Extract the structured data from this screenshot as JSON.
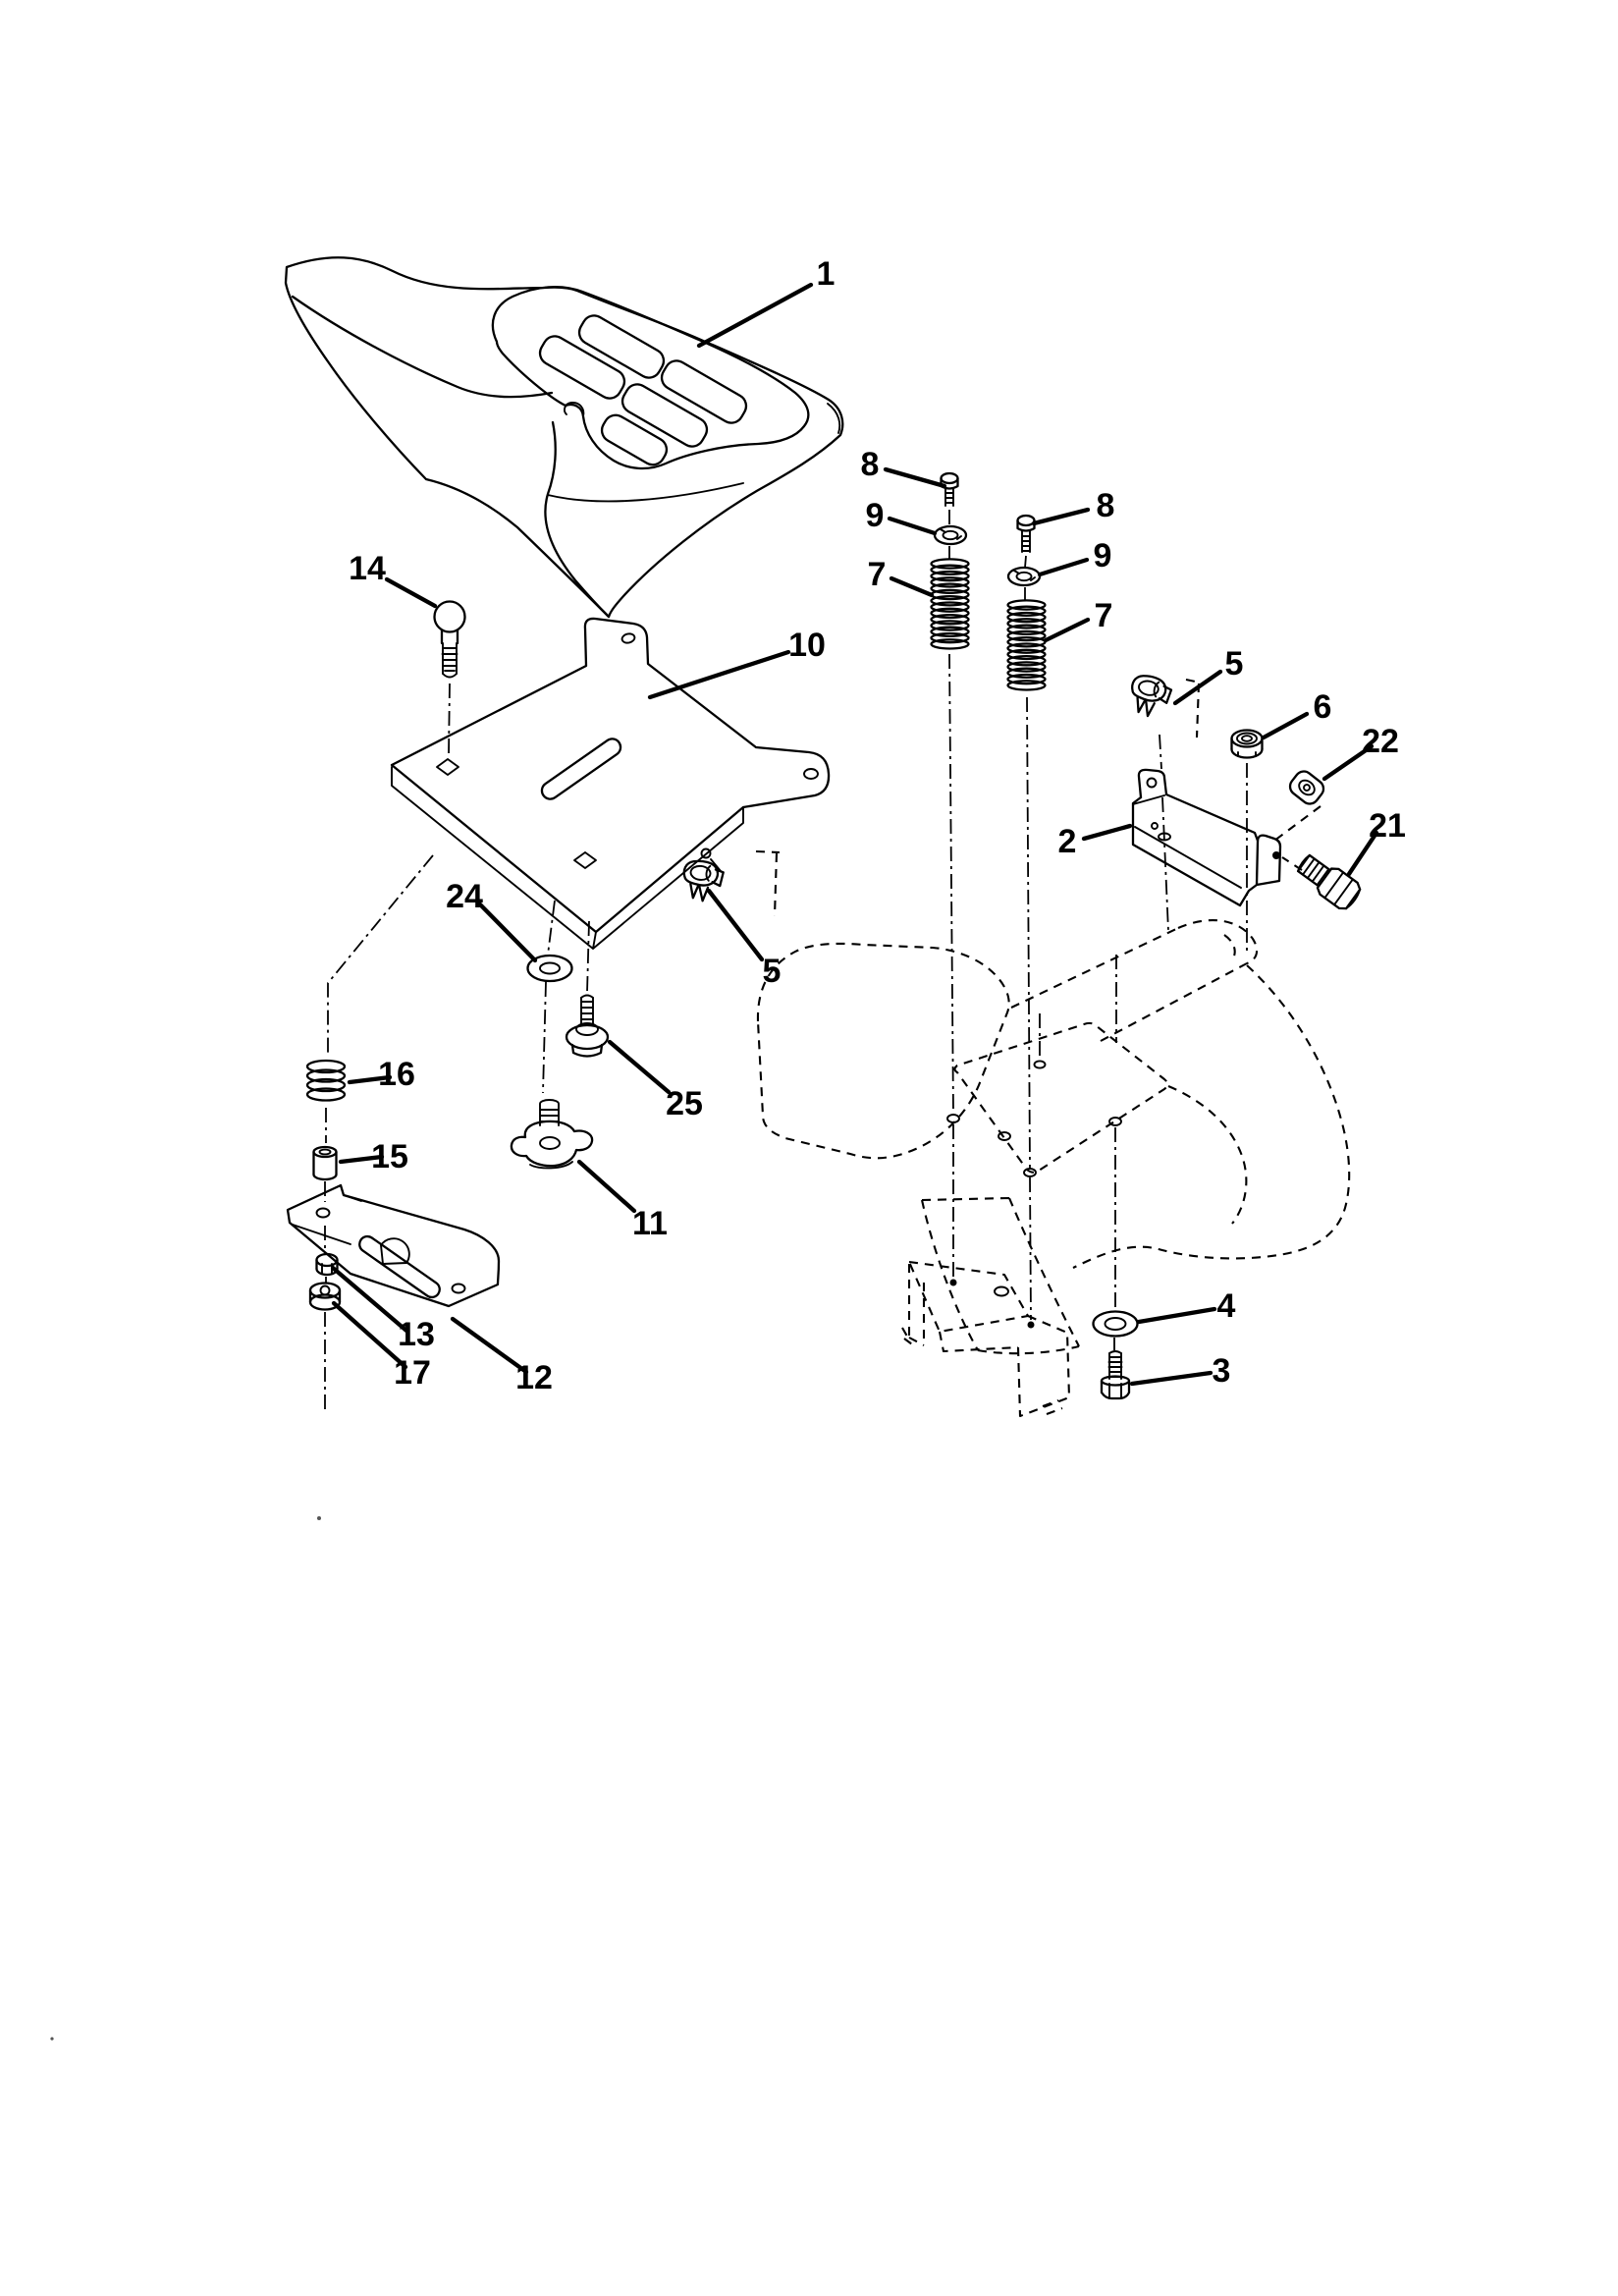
{
  "figure": {
    "type": "exploded-parts-diagram",
    "background": "#ffffff",
    "ink": "#000000",
    "callouts": [
      "1",
      "14",
      "10",
      "8",
      "9",
      "7",
      "8",
      "9",
      "7",
      "5",
      "6",
      "22",
      "2",
      "21",
      "5",
      "24",
      "25",
      "11",
      "16",
      "15",
      "13",
      "17",
      "12",
      "4",
      "3"
    ]
  }
}
